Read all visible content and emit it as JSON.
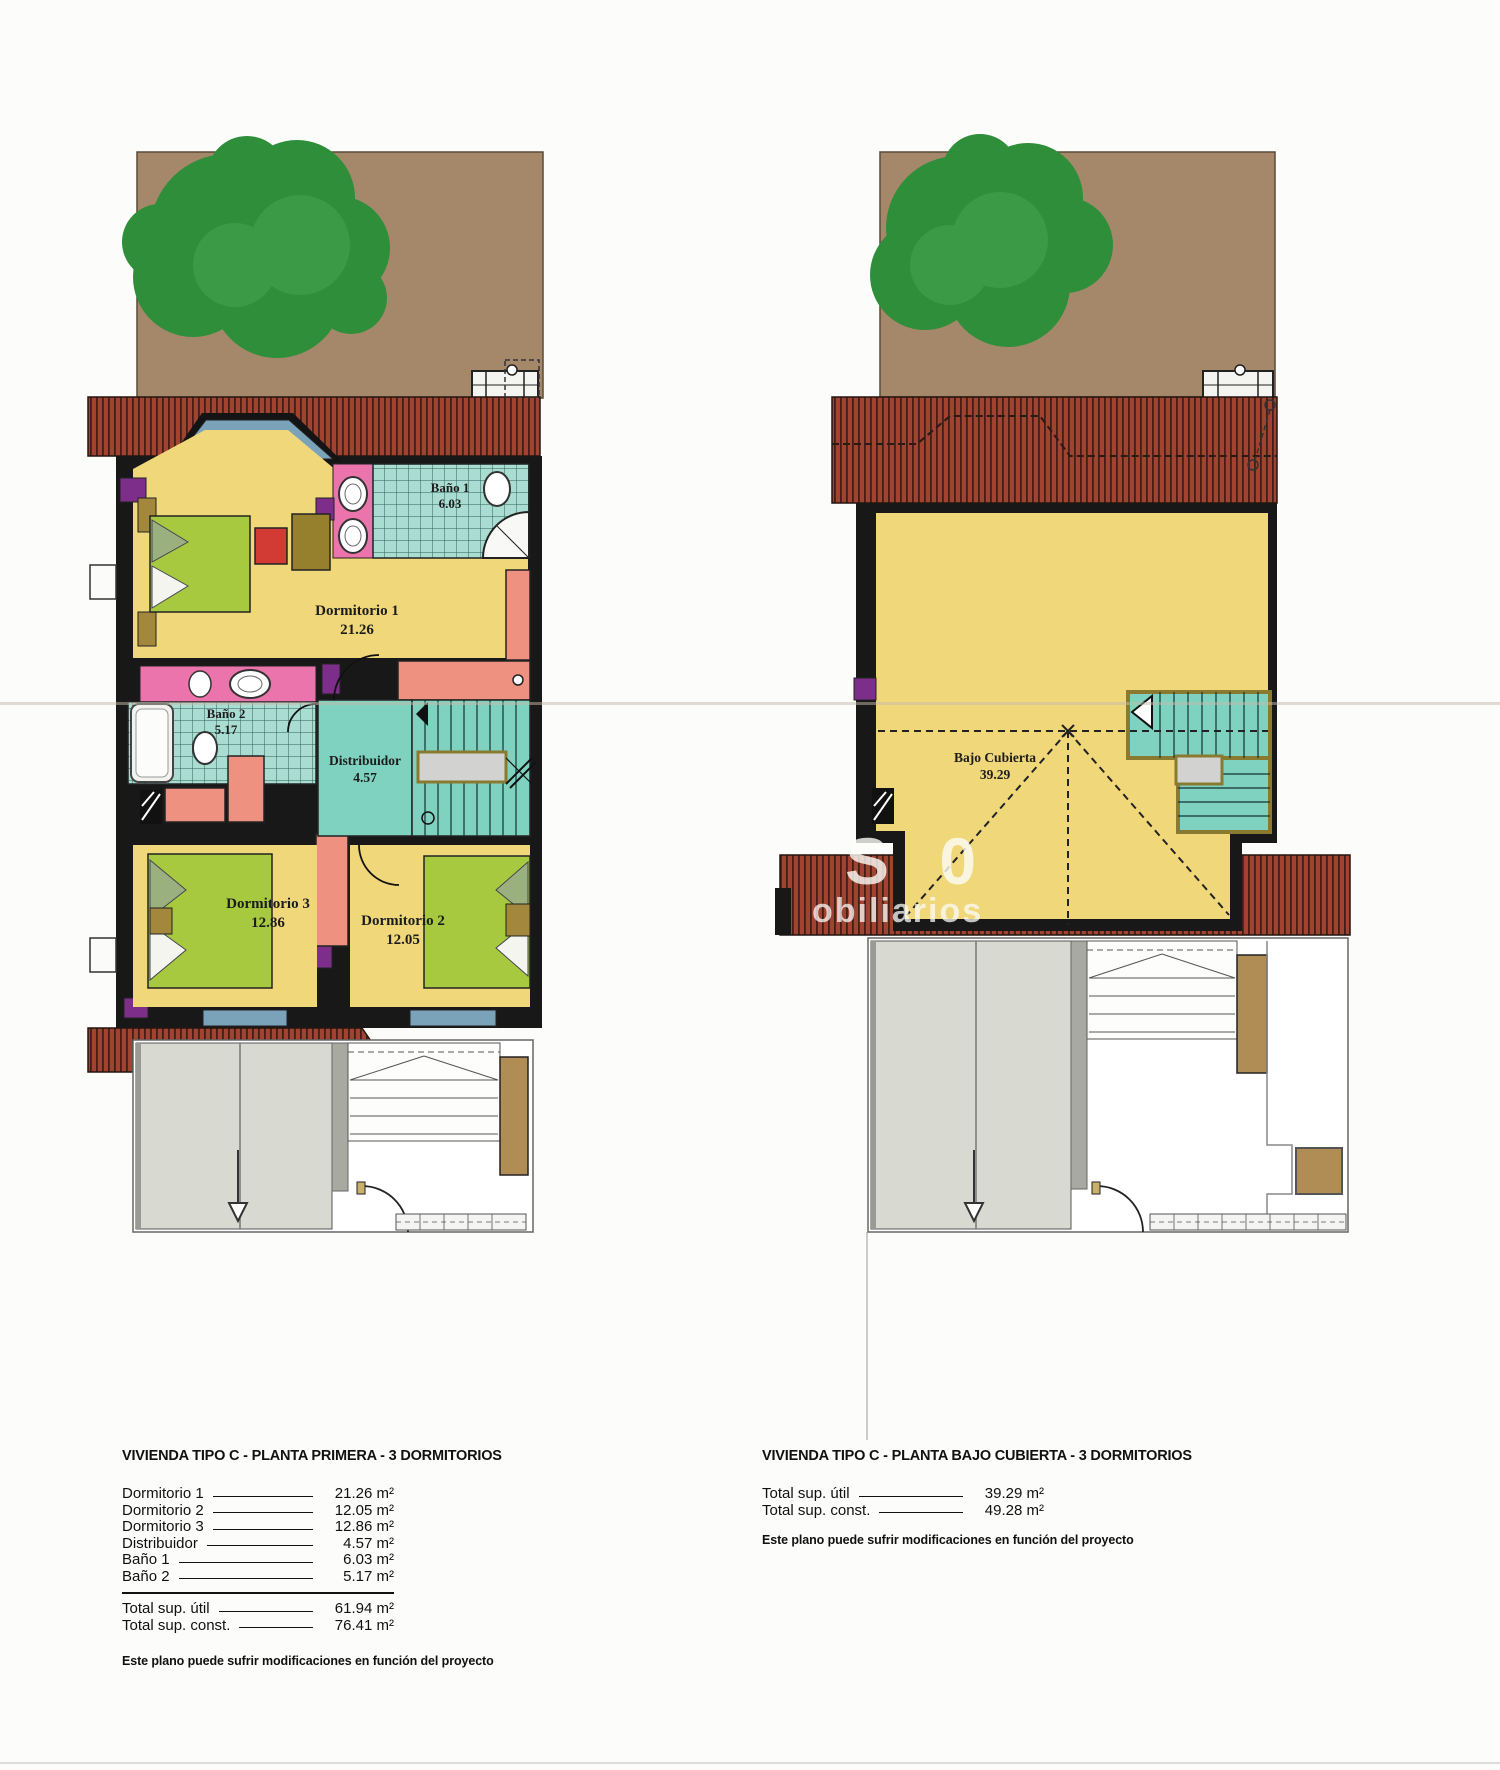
{
  "colors": {
    "roof_red": "#a04330",
    "roof_stripe": "#3f1f17",
    "wall_black": "#181818",
    "room_yellow": "#f0d87a",
    "tile_teal": "#aaddd2",
    "stair_teal": "#7ed2bf",
    "bed_green": "#a7c93f",
    "vanity_pink": "#ec74ac",
    "closet_salmon": "#ef9181",
    "accent_purple": "#7c2e8a",
    "window_blue": "#7aa2b9",
    "garden_brown": "#a5886a",
    "tree_green": "#2e8e3a",
    "ground_gray": "#d8dad2",
    "plank_brown": "#b08d55"
  },
  "watermark": {
    "big": "S 0",
    "small": "obiliarios"
  },
  "plans": {
    "left": {
      "title": "VIVIENDA TIPO C - PLANTA PRIMERA - 3 DORMITORIOS",
      "rooms": {
        "bano1": {
          "name": "Baño 1",
          "area": "6.03"
        },
        "dorm1": {
          "name": "Dormitorio 1",
          "area": "21.26"
        },
        "bano2": {
          "name": "Baño 2",
          "area": "5.17"
        },
        "distribuidor": {
          "name": "Distribuidor",
          "area": "4.57"
        },
        "dorm3": {
          "name": "Dormitorio 3",
          "area": "12.86"
        },
        "dorm2": {
          "name": "Dormitorio 2",
          "area": "12.05"
        }
      },
      "table": {
        "rows": [
          {
            "label": "Dormitorio 1",
            "value": "21.26 m²"
          },
          {
            "label": "Dormitorio 2",
            "value": "12.05 m²"
          },
          {
            "label": "Dormitorio 3",
            "value": "12.86 m²"
          },
          {
            "label": "Distribuidor",
            "value": "4.57 m²"
          },
          {
            "label": "Baño 1",
            "value": "6.03 m²"
          },
          {
            "label": "Baño 2",
            "value": "5.17 m²"
          }
        ],
        "totals": [
          {
            "label": "Total sup. útil",
            "value": "61.94 m²"
          },
          {
            "label": "Total sup. const.",
            "value": "76.41 m²"
          }
        ]
      },
      "note": "Este plano puede sufrir modificaciones en función del proyecto"
    },
    "right": {
      "title": "VIVIENDA TIPO C - PLANTA BAJO CUBIERTA - 3 DORMITORIOS",
      "rooms": {
        "bajo_cubierta": {
          "name": "Bajo Cubierta",
          "area": "39.29"
        }
      },
      "table": {
        "totals": [
          {
            "label": "Total sup. útil",
            "value": "39.29 m²"
          },
          {
            "label": "Total sup. const.",
            "value": "49.28 m²"
          }
        ]
      },
      "note": "Este plano puede sufrir modificaciones en función del proyecto"
    }
  }
}
